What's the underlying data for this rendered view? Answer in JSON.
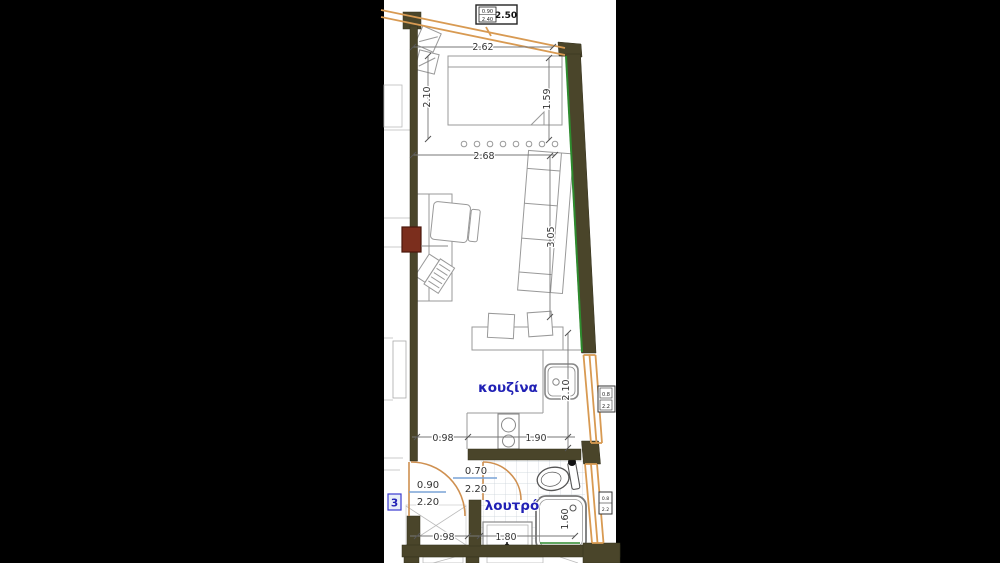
{
  "page": {
    "background": "#000000",
    "paper": "#ffffff"
  },
  "plan": {
    "room_labels": {
      "kitchen": "κουζίνα",
      "bathroom": "λουτρό"
    },
    "badges": {
      "room_number": "3"
    },
    "balcony_tag": {
      "line1": "0.90",
      "line2": "2.40",
      "value": "2.50"
    },
    "door_tags": {
      "entrance": {
        "width": "0.90",
        "height": "2.20"
      },
      "bathroom": {
        "width": "0.70",
        "height": "2.20"
      }
    },
    "edge_tags": {
      "upper": {
        "line1": "0.8",
        "line2": "2.2"
      },
      "lower": {
        "line1": "0.8",
        "line2": "2.2"
      }
    },
    "dimensions": {
      "top_width": "2.62",
      "upper_room_height": "2.10",
      "bed_length": "1.59",
      "mid_width": "2.68",
      "living_length": "3.05",
      "kitchen_run": "2.10",
      "bottom_left": "0.98",
      "bottom_right": "1.90",
      "hall_width": "0.98",
      "bath_width": "1.80",
      "shower_length": "1.60"
    },
    "colors": {
      "wall": "#4a452a",
      "window_frame": "#d89a52",
      "railing": "#d89a52",
      "wall_accent_green": "#2e8b2e",
      "column_red": "#7b2e1d",
      "label_blue": "#2121b5",
      "fraction_bar_blue": "#7aa3d6",
      "dim_text": "#333333",
      "furniture_line": "#999999",
      "tile_line": "#c9d1d8"
    }
  }
}
